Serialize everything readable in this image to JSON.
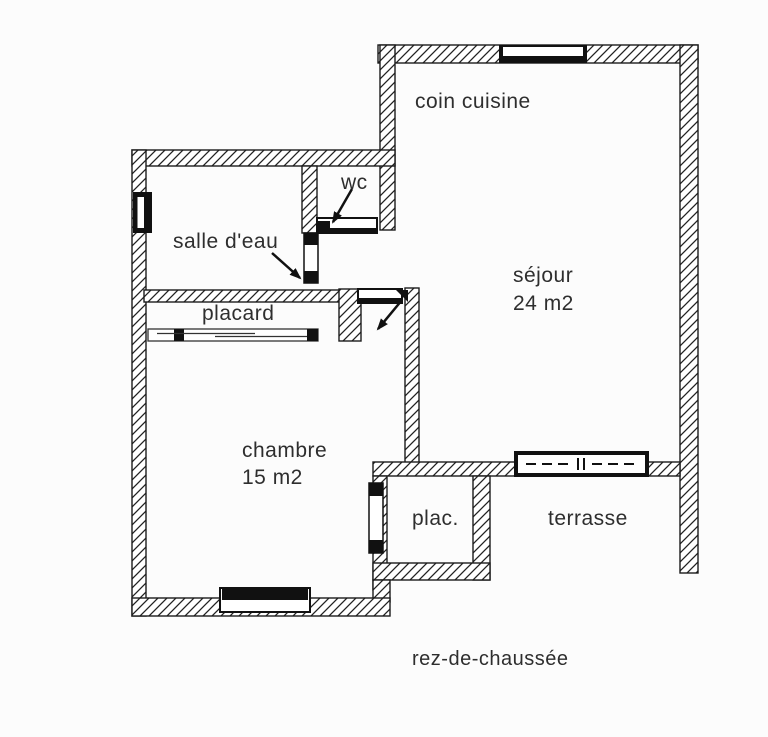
{
  "plan": {
    "floor_label": "rez-de-chaussée",
    "rooms": [
      {
        "id": "coin_cuisine",
        "label": "coin cuisine"
      },
      {
        "id": "sejour",
        "label": "séjour",
        "area": "24 m2"
      },
      {
        "id": "wc",
        "label": "wc"
      },
      {
        "id": "salle_deau",
        "label": "salle d'eau"
      },
      {
        "id": "placard",
        "label": "placard"
      },
      {
        "id": "chambre",
        "label": "chambre",
        "area": "15 m2"
      },
      {
        "id": "plac",
        "label": "plac."
      },
      {
        "id": "terrasse",
        "label": "terrasse"
      }
    ],
    "colors": {
      "background": "#fcfcfc",
      "wall_line": "#1c1c1c",
      "text": "#2e2e2e"
    }
  }
}
